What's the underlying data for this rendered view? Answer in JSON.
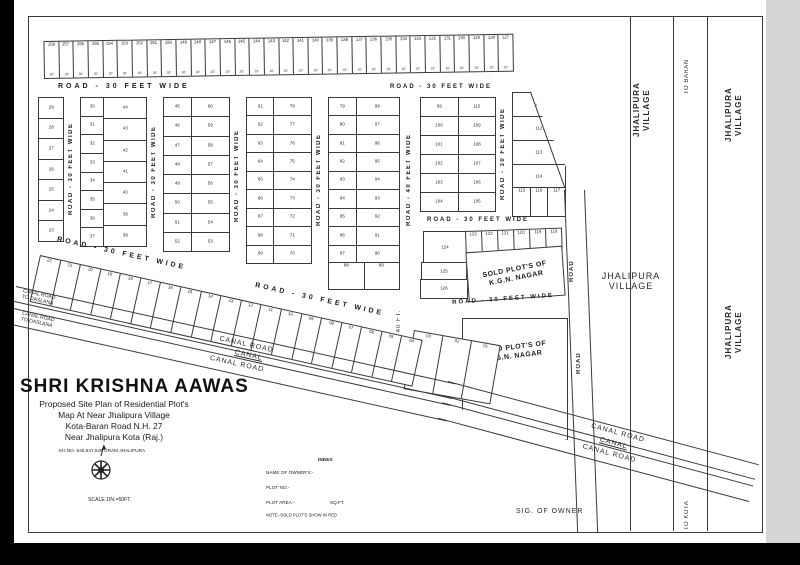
{
  "title_block": {
    "name": "SHRI  KRISHNA  AAWAS",
    "line1": "Proposed Site Plan of Residential Plot's",
    "line2": "Map At Near Jhalipura Village",
    "line3": "Kota-Baran Road N.H. 27",
    "line4": "Near Jhalipura Kota (Raj.)",
    "line5": "KH.NO.-646,647,648  GRAM  JHALIPURA",
    "scale": "SCALE  1IN.=50FT."
  },
  "index_block": {
    "heading": "INDEX",
    "row1": "NAME OF OWNER'S:-",
    "row2": "PLOT NO:-",
    "row3_label": "PLOT AREA:-",
    "row3_unit": "SQ.FT.",
    "note": "NOTE:-SOLD PLOT'S SHOW IN RED"
  },
  "signature": "SIG. OF OWNER",
  "villages": {
    "line1": "JHALIPURA",
    "line2": "VILLAGE"
  },
  "directions": {
    "to_baran": "TO BARAN",
    "to_kota": "TO KOTA"
  },
  "roads": {
    "r30": "ROAD - 30 FEET WIDE",
    "r40": "ROAD - 40 FEET WIDE",
    "r40ft": "ROAD - 40 FT.",
    "road": "ROAD"
  },
  "canal": {
    "canal_road": "CANAL ROAD",
    "canal": "CANAL",
    "daslana_line1": "CANAL ROAD",
    "daslana_line2": "TO DASLANA"
  },
  "sold": {
    "line1": "SOLD PLOT'S OF",
    "line2": "K.G.N.  NAGAR"
  },
  "plots": {
    "width_label": "20'",
    "top_strip": [
      "158",
      "157",
      "156",
      "155",
      "154",
      "153",
      "152",
      "151",
      "150",
      "149",
      "148",
      "147",
      "146",
      "145",
      "144",
      "143",
      "142",
      "141",
      "140",
      "139",
      "138",
      "137",
      "136",
      "135",
      "134",
      "133",
      "132",
      "131",
      "130",
      "129",
      "128",
      "127"
    ],
    "block_a": [
      "29",
      "28",
      "27",
      "26",
      "25",
      "24",
      "23"
    ],
    "block_b_left": [
      "30",
      "31",
      "32",
      "33",
      "34",
      "35",
      "36",
      "37"
    ],
    "block_b_right": [
      "44",
      "43",
      "42",
      "41",
      "40",
      "39",
      "38"
    ],
    "block_c_left": [
      "45",
      "46",
      "47",
      "48",
      "49",
      "50",
      "51",
      "52"
    ],
    "block_c_right": [
      "60",
      "59",
      "58",
      "57",
      "56",
      "55",
      "54",
      "53"
    ],
    "block_d_left": [
      "61",
      "62",
      "63",
      "64",
      "65",
      "66",
      "67",
      "68",
      "69"
    ],
    "block_d_right": [
      "78",
      "77",
      "76",
      "75",
      "74",
      "73",
      "72",
      "71",
      "70"
    ],
    "block_e_left": [
      "79",
      "80",
      "81",
      "82",
      "83",
      "84",
      "85",
      "86",
      "87"
    ],
    "block_e_right": [
      "98",
      "97",
      "96",
      "95",
      "94",
      "93",
      "92",
      "91",
      "90"
    ],
    "block_e_bottom": [
      "88",
      "89"
    ],
    "block_f_left": [
      "99",
      "100",
      "101",
      "102",
      "103",
      "104"
    ],
    "block_f_right": [
      "110",
      "109",
      "108",
      "107",
      "106",
      "105"
    ],
    "block_g": [
      "111",
      "112",
      "113",
      "114"
    ],
    "block_g_bottom": [
      "115",
      "116",
      "117"
    ],
    "plot_124": "124",
    "block_h_row": [
      "123",
      "122",
      "121",
      "120",
      "119",
      "118"
    ],
    "plot_125": "125",
    "plot_126": "126",
    "diag_row": [
      "22",
      "21",
      "20",
      "19",
      "18",
      "17",
      "16",
      "15",
      "14",
      "13",
      "12",
      "11",
      "10",
      "09",
      "08",
      "07",
      "06",
      "05",
      "04"
    ],
    "mini_block": [
      "03",
      "02",
      "01"
    ]
  }
}
